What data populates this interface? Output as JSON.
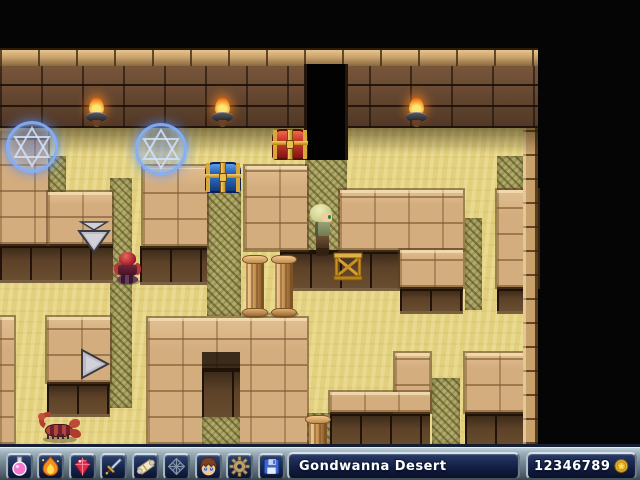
{
  "toolbar": {
    "buttons": [
      {
        "name": "potion-item-button",
        "icon": "potion-icon"
      },
      {
        "name": "fire-spell-button",
        "icon": "fire-icon"
      },
      {
        "name": "gem-button",
        "icon": "gem-icon"
      },
      {
        "name": "sword-equipment-button",
        "icon": "sword-icon"
      },
      {
        "name": "scroll-quest-button",
        "icon": "scroll-icon"
      },
      {
        "name": "net-grid-button",
        "icon": "net-grid-icon"
      },
      {
        "name": "character-status-button",
        "icon": "character-portrait-icon"
      },
      {
        "name": "settings-button",
        "icon": "gear-icon"
      },
      {
        "name": "save-button",
        "icon": "floppy-disk-icon"
      }
    ],
    "location_label": "Gondwanna Desert",
    "money": "12346789",
    "money_icon": "gold-coin-icon"
  },
  "map": {
    "area_name": "Gondwanna Desert",
    "objects": [
      "torch",
      "torch",
      "torch",
      "magic-circle",
      "magic-circle",
      "red-chest",
      "blue-chest",
      "dark-doorway",
      "down-arrow-sign",
      "right-arrow-sign",
      "red-beetle-monster",
      "scorpion-monster",
      "player-character",
      "bench",
      "pillar",
      "pillar",
      "pillar"
    ],
    "colors": {
      "void": "#050505",
      "sand": "#e2d07e",
      "mottled_sand": "#b3ab6b",
      "wall_brick": "#d4ad7e",
      "dark_wall": "#6b4a33",
      "ledge_face": "#5d4228",
      "magic_circle": "#82afff",
      "torch_flame": "#f5a030",
      "red_chest": "#c03428",
      "blue_chest": "#2868c0",
      "gold_trim": "#d8a838",
      "toolbar_metal": "#9fb2be",
      "panel_navy": "#131f44",
      "coin_gold": "#e8b830"
    }
  }
}
